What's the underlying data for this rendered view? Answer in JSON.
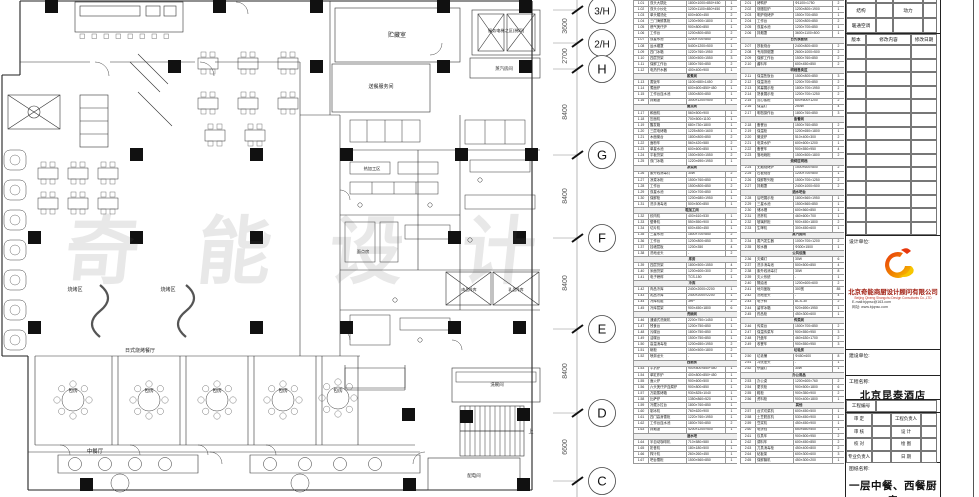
{
  "watermark": "奇能设计",
  "plan": {
    "labels": [
      {
        "x": 397,
        "y": 37,
        "t": "贮藏室",
        "s": 6
      },
      {
        "x": 506,
        "y": 32,
        "t": "服务电梯之区(梯四)",
        "s": 4.2
      },
      {
        "x": 504,
        "y": 70,
        "t": "蒸汽房间",
        "s": 4.4
      },
      {
        "x": 381,
        "y": 88,
        "t": "送餐服务间",
        "s": 5
      },
      {
        "x": 75,
        "y": 291,
        "t": "烧烤区",
        "s": 5
      },
      {
        "x": 168,
        "y": 291,
        "t": "烧烤区",
        "s": 5
      },
      {
        "x": 140,
        "y": 352,
        "t": "日式烧烤餐厅",
        "s": 5
      },
      {
        "x": 73,
        "y": 392,
        "t": "包房",
        "s": 4.8
      },
      {
        "x": 149,
        "y": 392,
        "t": "包房",
        "s": 4.8
      },
      {
        "x": 217,
        "y": 392,
        "t": "包房",
        "s": 4.8
      },
      {
        "x": 283,
        "y": 392,
        "t": "包房",
        "s": 4.8
      },
      {
        "x": 338,
        "y": 392,
        "t": "包房",
        "s": 4.8
      },
      {
        "x": 95,
        "y": 453,
        "t": "中餐厅",
        "s": 5.4
      },
      {
        "x": 469,
        "y": 291,
        "t": "肉品冷库",
        "s": 3.8
      },
      {
        "x": 516,
        "y": 291,
        "t": "乳品冷库",
        "s": 3.8
      },
      {
        "x": 497,
        "y": 386,
        "t": "洗碗间",
        "s": 4.4
      },
      {
        "x": 474,
        "y": 477,
        "t": "配电间",
        "s": 4.4
      },
      {
        "x": 531,
        "y": 433,
        "t": "上",
        "s": 5
      },
      {
        "x": 372,
        "y": 170,
        "t": "热加工区",
        "s": 4.2
      },
      {
        "x": 363,
        "y": 253,
        "t": "面点房",
        "s": 4.2
      }
    ]
  },
  "grid": {
    "bubbles": [
      {
        "y": 10,
        "label": "3/H"
      },
      {
        "y": 43,
        "label": "2/H"
      },
      {
        "y": 69,
        "label": "H"
      },
      {
        "y": 155,
        "label": "G"
      },
      {
        "y": 238,
        "label": "F"
      },
      {
        "y": 329,
        "label": "E"
      },
      {
        "y": 413,
        "label": "D"
      },
      {
        "y": 481,
        "label": "C"
      }
    ],
    "dimensions": [
      {
        "y": 26,
        "v": "3600"
      },
      {
        "y": 56,
        "v": "2700"
      },
      {
        "y": 112,
        "v": "8400"
      },
      {
        "y": 196,
        "v": "8400"
      },
      {
        "y": 283,
        "v": "8400"
      },
      {
        "y": 371,
        "v": "8400"
      },
      {
        "y": 447,
        "v": "6600"
      }
    ]
  },
  "equipment": {
    "left": [
      [
        "1.01",
        "双头大锅灶",
        "1800×1000×850+450",
        "1",
        "台"
      ],
      [
        "1.02",
        "双头小炒灶",
        "1200×1100×850+450",
        "2",
        "台"
      ],
      [
        "1.03",
        "单头矮汤灶",
        "600×600×450",
        "2",
        "台"
      ],
      [
        "1.04",
        "三门海鲜蒸柜",
        "1200×900×1800",
        "1",
        "台"
      ],
      [
        "1.05",
        "燃气煲仔炉",
        "900×800×850",
        "1",
        "台"
      ],
      [
        "1.06",
        "工作台",
        "1200×800×850",
        "2",
        "张"
      ],
      [
        "1.07",
        "双星水池",
        "1200×700×850",
        "2",
        "个"
      ],
      [
        "1.08",
        "运水烟罩",
        "5400×1200×500",
        "1",
        "套"
      ],
      [
        "1.09",
        "四门冰箱",
        "1220×760×1950",
        "2",
        "台"
      ],
      [
        "1.10",
        "四层货架",
        "1500×500×1550",
        "3",
        "个"
      ],
      [
        "1.11",
        "保鲜工作台",
        "1800×760×850",
        "2",
        "台"
      ],
      [
        "1.12",
        "电热开水器",
        "400×400×900",
        "1",
        "台"
      ],
      [
        "蒸煮间"
      ],
      [
        "1.13",
        "蒸饭车",
        "1100×680×1450",
        "2",
        "台"
      ],
      [
        "1.14",
        "煮面炉",
        "600×600×850+450",
        "1",
        "台"
      ],
      [
        "1.15",
        "工作台连水池",
        "1500×800×850",
        "1",
        "张"
      ],
      [
        "1.16",
        "排烟罩",
        "3000×1200×500",
        "1",
        "套"
      ],
      [
        "面点间"
      ],
      [
        "1.17",
        "和面机",
        "560×500×900",
        "1",
        "台"
      ],
      [
        "1.18",
        "压面机",
        "700×500×1100",
        "1",
        "台"
      ],
      [
        "1.19",
        "醒发箱",
        "680×730×1800",
        "1",
        "台"
      ],
      [
        "1.20",
        "三层电烤箱",
        "1225×800×1600",
        "1",
        "台"
      ],
      [
        "1.21",
        "木面案台",
        "1800×800×850",
        "2",
        "张"
      ],
      [
        "1.22",
        "面粉车",
        "560×420×580",
        "2",
        "个"
      ],
      [
        "1.23",
        "单星水池",
        "600×600×850",
        "1",
        "个"
      ],
      [
        "1.24",
        "平板货架",
        "1500×500×1550",
        "2",
        "个"
      ],
      [
        "1.25",
        "双门冰箱",
        "1220×690×1950",
        "1",
        "台"
      ],
      [
        "凉菜间"
      ],
      [
        "1.26",
        "紫外线消毒灯",
        "30W",
        "2",
        "支"
      ],
      [
        "1.27",
        "凉菜冰柜",
        "1500×760×850",
        "1",
        "台"
      ],
      [
        "1.28",
        "工作台",
        "1500×800×850",
        "2",
        "张"
      ],
      [
        "1.29",
        "双星水池",
        "1200×700×850",
        "1",
        "个"
      ],
      [
        "1.30",
        "保鲜柜",
        "1200×680×1950",
        "1",
        "台"
      ],
      [
        "1.31",
        "洗手消毒池",
        "500×500×850",
        "1",
        "个"
      ],
      [
        "粗加工间"
      ],
      [
        "1.32",
        "绞肉机",
        "400×610×530",
        "1",
        "台"
      ],
      [
        "1.33",
        "锯骨机",
        "550×550×900",
        "1",
        "台"
      ],
      [
        "1.34",
        "切片机",
        "600×450×450",
        "1",
        "台"
      ],
      [
        "1.35",
        "三星水池",
        "1800×700×850",
        "2",
        "个"
      ],
      [
        "1.36",
        "工作台",
        "1200×800×850",
        "3",
        "张"
      ],
      [
        "1.37",
        "挂墙层板",
        "1200×350",
        "4",
        "块"
      ],
      [
        "1.38",
        "洗地龙头",
        "-",
        "2",
        "个"
      ],
      [
        "库房"
      ],
      [
        "1.39",
        "四层货架",
        "1800×500×1550",
        "4",
        "个"
      ],
      [
        "1.40",
        "米面货架",
        "1200×600×300",
        "2",
        "个"
      ],
      [
        "1.41",
        "电子磅秤",
        "TCS-150",
        "1",
        "台"
      ],
      [
        "冷库"
      ],
      [
        "1.42",
        "肉品冷库",
        "2400×2000×2200",
        "1",
        "间"
      ],
      [
        "1.43",
        "乳品冷库",
        "2400×2000×2200",
        "1",
        "间"
      ],
      [
        "1.44",
        "冷库机组",
        "3HP",
        "2",
        "套"
      ],
      [
        "1.45",
        "冷库层架",
        "900×450×1800",
        "6",
        "个"
      ],
      [
        "洗碗间"
      ],
      [
        "1.46",
        "通道式洗碗机",
        "2200×750×1450",
        "1",
        "台"
      ],
      [
        "1.47",
        "残食台",
        "1200×750×850",
        "1",
        "张"
      ],
      [
        "1.48",
        "污碟台",
        "1800×750×850",
        "1",
        "张"
      ],
      [
        "1.49",
        "洁碟台",
        "1500×750×850",
        "1",
        "张"
      ],
      [
        "1.50",
        "高温消毒柜",
        "1200×650×1950",
        "2",
        "台"
      ],
      [
        "1.51",
        "碗柜",
        "1500×500×1800",
        "2",
        "个"
      ],
      [
        "1.52",
        "喷淋龙头",
        "-",
        "1",
        "套"
      ],
      [
        "西厨房"
      ],
      [
        "1.53",
        "平扒炉",
        "900×800×850+450",
        "1",
        "台"
      ],
      [
        "1.54",
        "单缸炸炉",
        "400×800×850+450",
        "1",
        "台"
      ],
      [
        "1.55",
        "面火炉",
        "900×600×500",
        "1",
        "台"
      ],
      [
        "1.56",
        "六头煲仔炉连焗炉",
        "900×800×850",
        "1",
        "台"
      ],
      [
        "1.57",
        "万能蒸烤箱",
        "930×825×1040",
        "1",
        "台"
      ],
      [
        "1.58",
        "比萨炉",
        "1350×860×520",
        "1",
        "台"
      ],
      [
        "1.59",
        "冷藏沙拉台",
        "1800×760×850",
        "1",
        "台"
      ],
      [
        "1.60",
        "制冰机",
        "760×620×900",
        "1",
        "台"
      ],
      [
        "1.61",
        "四门高身雪柜",
        "1220×760×1950",
        "1",
        "台"
      ],
      [
        "1.62",
        "工作台连水池",
        "1800×760×850",
        "2",
        "张"
      ],
      [
        "1.63",
        "排烟罩",
        "4200×1200×500",
        "1",
        "套"
      ],
      [
        "酒水吧"
      ],
      [
        "1.64",
        "半自动咖啡机",
        "710×580×580",
        "1",
        "台"
      ],
      [
        "1.65",
        "奶昔机",
        "180×180×500",
        "1",
        "台"
      ],
      [
        "1.66",
        "榨汁机",
        "260×260×450",
        "1",
        "台"
      ],
      [
        "1.67",
        "吧台雪柜",
        "1500×560×850",
        "1",
        "台"
      ]
    ],
    "right": [
      [
        "2.01",
        "烤鸭炉",
        "Φ1100×1750",
        "2",
        "台"
      ],
      [
        "2.02",
        "烧腊挂炉",
        "1200×800×1900",
        "1",
        "台"
      ],
      [
        "2.03",
        "明炉烧烤炉",
        "1500×700×850",
        "1",
        "台"
      ],
      [
        "2.04",
        "工作台",
        "1200×800×850",
        "2",
        "张"
      ],
      [
        "2.05",
        "双星水池",
        "1200×700×850",
        "1",
        "个"
      ],
      [
        "2.06",
        "排烟罩",
        "3600×1100×500",
        "1",
        "套"
      ],
      [
        "日式铁板烧"
      ],
      [
        "2.07",
        "铁板烧台",
        "2400×800×800",
        "2",
        "台"
      ],
      [
        "2.08",
        "专用排烟罩",
        "2600×1000×500",
        "2",
        "套"
      ],
      [
        "2.09",
        "保鲜工作台",
        "1500×760×850",
        "2",
        "台"
      ],
      [
        "2.10",
        "酱料车",
        "600×450×850",
        "2",
        "个"
      ],
      [
        "明档售卖区"
      ],
      [
        "2.11",
        "保温售饭台",
        "1500×800×850",
        "3",
        "台"
      ],
      [
        "2.12",
        "保温汤池",
        "1200×700×850",
        "2",
        "台"
      ],
      [
        "2.13",
        "风幕展示柜",
        "1800×700×1950",
        "2",
        "台"
      ],
      [
        "2.14",
        "熟食展示柜",
        "1200×700×1250",
        "2",
        "台"
      ],
      [
        "2.15",
        "点心蒸柜",
        "600×600×1200",
        "2",
        "台"
      ],
      [
        "2.16",
        "保温灯",
        "250W",
        "4",
        "个"
      ],
      [
        "2.17",
        "明档操作台",
        "1800×760×850",
        "3",
        "张"
      ],
      [
        "备餐间"
      ],
      [
        "2.18",
        "备餐台",
        "1500×760×850",
        "2",
        "张"
      ],
      [
        "2.19",
        "保温柜",
        "1200×650×1800",
        "1",
        "台"
      ],
      [
        "2.20",
        "微波炉",
        "510×400×300",
        "2",
        "台"
      ],
      [
        "2.21",
        "电茶水炉",
        "600×600×1200",
        "1",
        "台"
      ],
      [
        "2.22",
        "备餐车",
        "900×550×950",
        "4",
        "辆"
      ],
      [
        "2.23",
        "落地碗柜",
        "1500×500×1800",
        "2",
        "个"
      ],
      [
        "烧烤区明档"
      ],
      [
        "2.24",
        "无烟烧烤炉",
        "1500×600×800",
        "2",
        "台"
      ],
      [
        "2.25",
        "石板烧台",
        "1200×700×800",
        "1",
        "台"
      ],
      [
        "2.26",
        "保鲜陈列柜",
        "1500×700×1250",
        "2",
        "台"
      ],
      [
        "2.27",
        "排烟罩",
        "2400×1000×500",
        "2",
        "套"
      ],
      [
        "酒水吧台"
      ],
      [
        "2.28",
        "后吧展示柜",
        "1800×560×1950",
        "1",
        "台"
      ],
      [
        "2.29",
        "三星水池",
        "1500×560×850",
        "1",
        "个"
      ],
      [
        "2.30",
        "储冰槽",
        "600×560×850",
        "1",
        "个"
      ],
      [
        "2.31",
        "洗杯机",
        "460×600×700",
        "1",
        "台"
      ],
      [
        "2.32",
        "玻璃杯柜",
        "900×450×1800",
        "2",
        "个"
      ],
      [
        "2.33",
        "生啤机",
        "300×450×600",
        "1",
        "台"
      ],
      [
        "蒸汽房间"
      ],
      [
        "2.34",
        "蒸汽发生器",
        "1000×700×1200",
        "2",
        "台"
      ],
      [
        "2.35",
        "软水器",
        "Φ300×1500",
        "1",
        "套"
      ],
      [
        "公共设施"
      ],
      [
        "2.36",
        "灭蝇灯",
        "30W",
        "6",
        "个"
      ],
      [
        "2.37",
        "洗手消毒池",
        "500×500×850",
        "4",
        "个"
      ],
      [
        "2.38",
        "紫外线消毒灯",
        "30W",
        "8",
        "支"
      ],
      [
        "2.39",
        "灭火系统",
        "-",
        "1",
        "套"
      ],
      [
        "2.40",
        "隔油池",
        "1200×600×600",
        "2",
        "个"
      ],
      [
        "2.41",
        "地沟盖板",
        "300宽",
        "85",
        "m"
      ],
      [
        "2.42",
        "洗地龙头",
        "-",
        "4",
        "个"
      ],
      [
        "2.43",
        "电子秤",
        "ACS-30",
        "2",
        "台"
      ],
      [
        "2.44",
        "留样冰箱",
        "920×690×1950",
        "1",
        "台"
      ],
      [
        "2.45",
        "药品柜",
        "450×300×600",
        "1",
        "个"
      ],
      [
        "传菜间"
      ],
      [
        "2.46",
        "传菜台",
        "1500×700×850",
        "2",
        "张"
      ],
      [
        "2.47",
        "保温传菜车",
        "900×550×950",
        "3",
        "辆"
      ],
      [
        "2.48",
        "托盘车",
        "460×630×1700",
        "2",
        "辆"
      ],
      [
        "2.49",
        "收餐车",
        "900×550×950",
        "3",
        "辆"
      ],
      [
        "垃圾房"
      ],
      [
        "2.50",
        "垃圾桶",
        "Φ450×600",
        "8",
        "个"
      ],
      [
        "2.51",
        "冲洗龙头",
        "-",
        "1",
        "个"
      ],
      [
        "2.52",
        "杀菌灯",
        "30W",
        "1",
        "支"
      ],
      [
        "办公用品"
      ],
      [
        "2.53",
        "办公桌",
        "1200×600×760",
        "2",
        "张"
      ],
      [
        "2.54",
        "更衣柜",
        "900×500×1800",
        "6",
        "个"
      ],
      [
        "2.55",
        "鞋柜",
        "900×350×900",
        "2",
        "个"
      ],
      [
        "2.56",
        "资料柜",
        "900×400×1800",
        "1",
        "个"
      ],
      [
        "其他"
      ],
      [
        "2.57",
        "台式切菜机",
        "600×450×500",
        "1",
        "台"
      ],
      [
        "2.58",
        "土豆脱皮机",
        "530×450×900",
        "1",
        "台"
      ],
      [
        "2.59",
        "豆浆机",
        "450×450×900",
        "1",
        "台"
      ],
      [
        "2.60",
        "电饼铛",
        "650×650×500",
        "1",
        "台"
      ],
      [
        "2.61",
        "炊具车",
        "900×500×950",
        "2",
        "辆"
      ],
      [
        "2.62",
        "调料车",
        "600×450×850",
        "2",
        "个"
      ],
      [
        "2.63",
        "刀具消毒柜",
        "450×400×800",
        "2",
        "台"
      ],
      [
        "2.64",
        "砧板架",
        "600×300×600",
        "3",
        "个"
      ],
      [
        "2.65",
        "保鲜膜机",
        "450×300×200",
        "1",
        "台"
      ]
    ]
  },
  "titleblock": {
    "disciplines": [
      [
        "给水",
        "",
        "电气",
        ""
      ],
      [
        "结构",
        "",
        "动力",
        ""
      ],
      [
        "暖通空调",
        "",
        "",
        ""
      ]
    ],
    "revision_header": [
      "版本",
      "修改内容",
      "修改日期"
    ],
    "design_unit_label": "设计单位:",
    "company_cn": "北京奇能商厨设计顾问有限公司",
    "company_en": "Beijing Qineng Shangchu Design Consultants Co.,LTD",
    "email": "E-mail:bjqnsc@163.com",
    "website": "网址: www.bjqnsc.com",
    "client_label": "建设单位:",
    "project_label": "工程名称:",
    "project_name": "北京昆泰酒店",
    "project_no_label": "工程编号",
    "signs": [
      [
        "审 定",
        "",
        "工程负责人",
        ""
      ],
      [
        "审 核",
        "",
        "设 计",
        ""
      ],
      [
        "校 对",
        "",
        "绘 图",
        ""
      ],
      [
        "专业负责人",
        "",
        "日 期",
        ""
      ]
    ],
    "drawing_label": "图纸名称:",
    "drawing_name": "一层中餐、西餐厨房"
  },
  "colors": {
    "line": "#222222",
    "column_fill": "#111111",
    "company_red": "#a01d10",
    "logo_red": "#e8380d",
    "logo_orange": "#f08300",
    "logo_yellow": "#f7c600"
  }
}
